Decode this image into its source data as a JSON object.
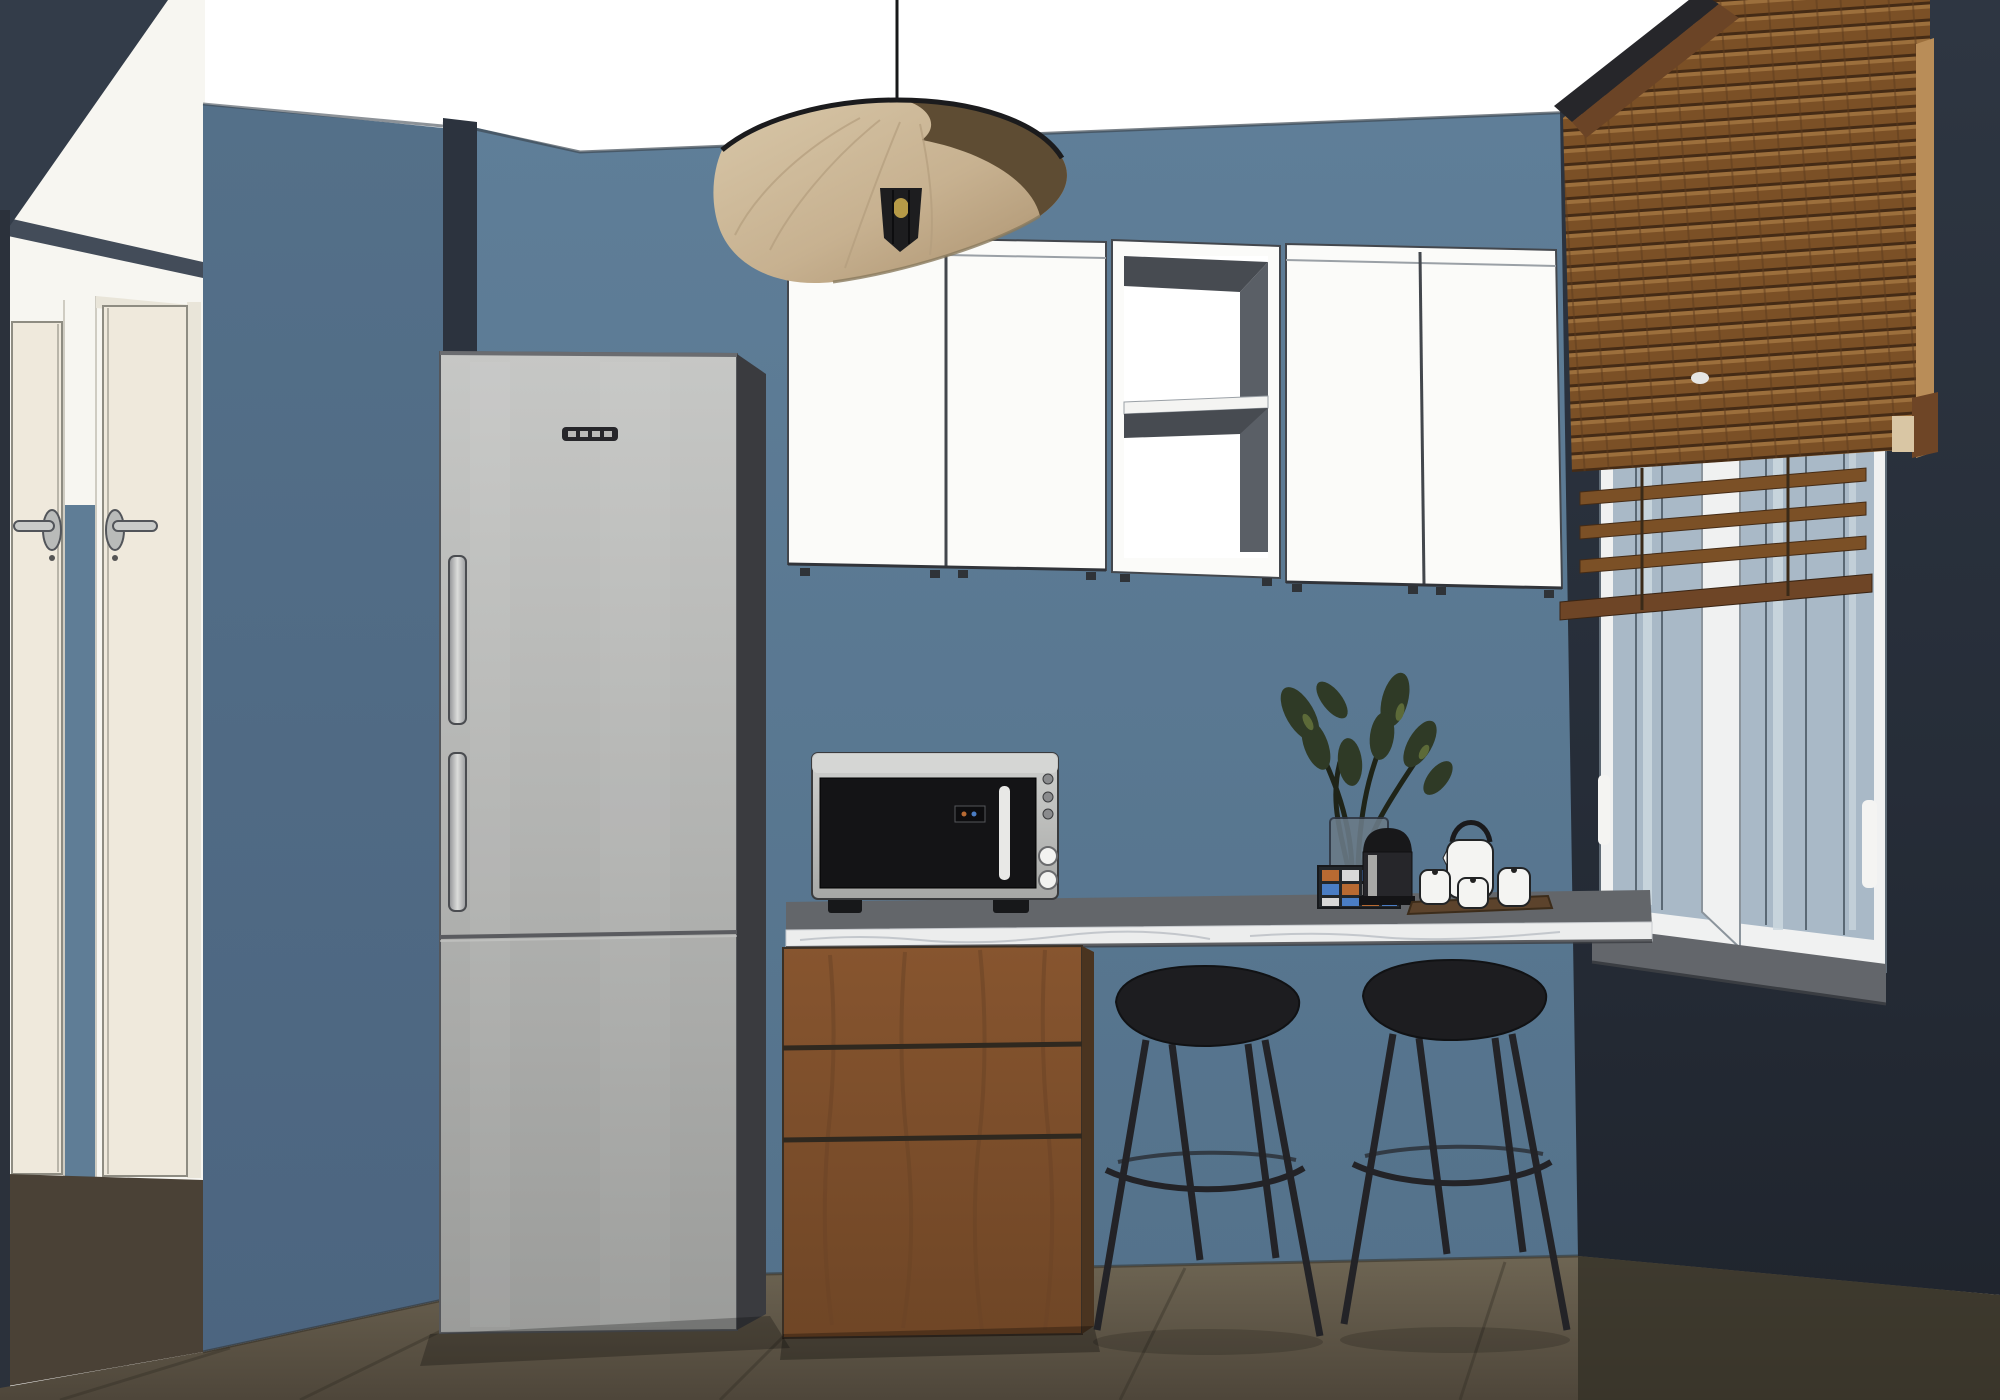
{
  "meta": {
    "type": "3d-interior-render",
    "style": "sketchup-like",
    "room": "kitchen-dining-corner"
  },
  "objects": [
    "ceiling",
    "back-wall",
    "left-partition-wall",
    "right-dark-wall",
    "corner-column",
    "hallway",
    "hall-door-left",
    "hall-door-right",
    "door-lever-handles",
    "pendant-lamp-vertigo",
    "refrigerator-stainless",
    "fridge-brand-label",
    "upper-cabinet-left",
    "open-shelf-unit",
    "upper-cabinet-right",
    "wood-venetian-blinds",
    "casement-window",
    "window-sill",
    "marble-countertop",
    "walnut-drawer-unit",
    "microwave-oven",
    "mosaic-vase-with-plant",
    "capsule-coffee-machine",
    "tea-set-on-tray",
    "bar-stool-left",
    "bar-stool-right",
    "tiled-floor"
  ],
  "palette": {
    "ceiling": "#ffffff",
    "wall_back": "#5d7c96",
    "wall_left": "#527089",
    "wall_dark": "#2a313d",
    "wall_dark_low": "#20252e",
    "wedge": "#333c49",
    "lintel": "#434c59",
    "edge_strip": "#2b313b",
    "column_dark": "#2c333e",
    "hall_white": "#f7f6f1",
    "door_cream": "#efe9dc",
    "door_frame": "#e9e5d9",
    "door_line": "#8e8c82",
    "handle_metal": "#c9cbc9",
    "handle_dark": "#52555a",
    "hall_blue": "#5f7d96",
    "hall_floor": "#4a4136",
    "floor_main": "#6a6150",
    "floor_right": "#363228",
    "seam": "#2e2a21",
    "fridge_light": "#c6c7c5",
    "fridge_mid": "#a8a9a7",
    "fridge_side": "#3a3b3f",
    "fridge_seam": "#5a5b5f",
    "fridge_label": "#26262a",
    "cab_white": "#fbfbf9",
    "cab_line": "#43474d",
    "cab_int_dark": "#474b51",
    "cab_int_mid": "#5a5f66",
    "counter_top": "#63666a",
    "marble": "#eceded",
    "marble_vein": "#b9bdc3",
    "counter_shadow": "#3c3e42",
    "wood": "#7d5130",
    "wood_dark": "#4a3420",
    "wood_streak": "#6b4426",
    "wood_gap": "#2f281f",
    "blind_wood": "#7b5026",
    "blind_lit": "#9c6f3c",
    "blind_gap": "#452b15",
    "blind_rail": "#b98d58",
    "blind_cap": "#6e4526",
    "blind_block": "#d9c6a4",
    "pelmet": "#26262a",
    "cord": "#3a2a18",
    "cord_dot": "#e6e6e4",
    "window_frame": "#f0f1f1",
    "glass": "#a9b9c7",
    "glass_light": "#cdd8df",
    "glass_line": "#5a6874",
    "sill": "#63666b",
    "micro_body": "#b5b6b4",
    "micro_top": "#d6d7d5",
    "micro_door": "#141416",
    "micro_handle": "#e8e8e6",
    "micro_knob": "#f2f2f0",
    "stool": "#1d1d20",
    "stool_line": "#232327",
    "lamp_shade": "#c7b190",
    "lamp_top": "#5e4c33",
    "lamp_rim": "#1b1b1d",
    "bulb": "#c8a84b",
    "plant_leaf": "#2f3a26",
    "plant_leaf2": "#5c6a38",
    "branch": "#1f2418",
    "vase_glass": "#6b7b88",
    "mosaic_dark": "#23272b",
    "tile_orange": "#b86a32",
    "tile_blue": "#4a7dc4",
    "tile_white": "#d8d8d8",
    "coffee_dark": "#18181a",
    "coffee_body": "#26262a",
    "coffee_metal": "#a9a9a7",
    "tray": "#5c432c",
    "china": "#f4f4f2",
    "china_line": "#222426"
  }
}
